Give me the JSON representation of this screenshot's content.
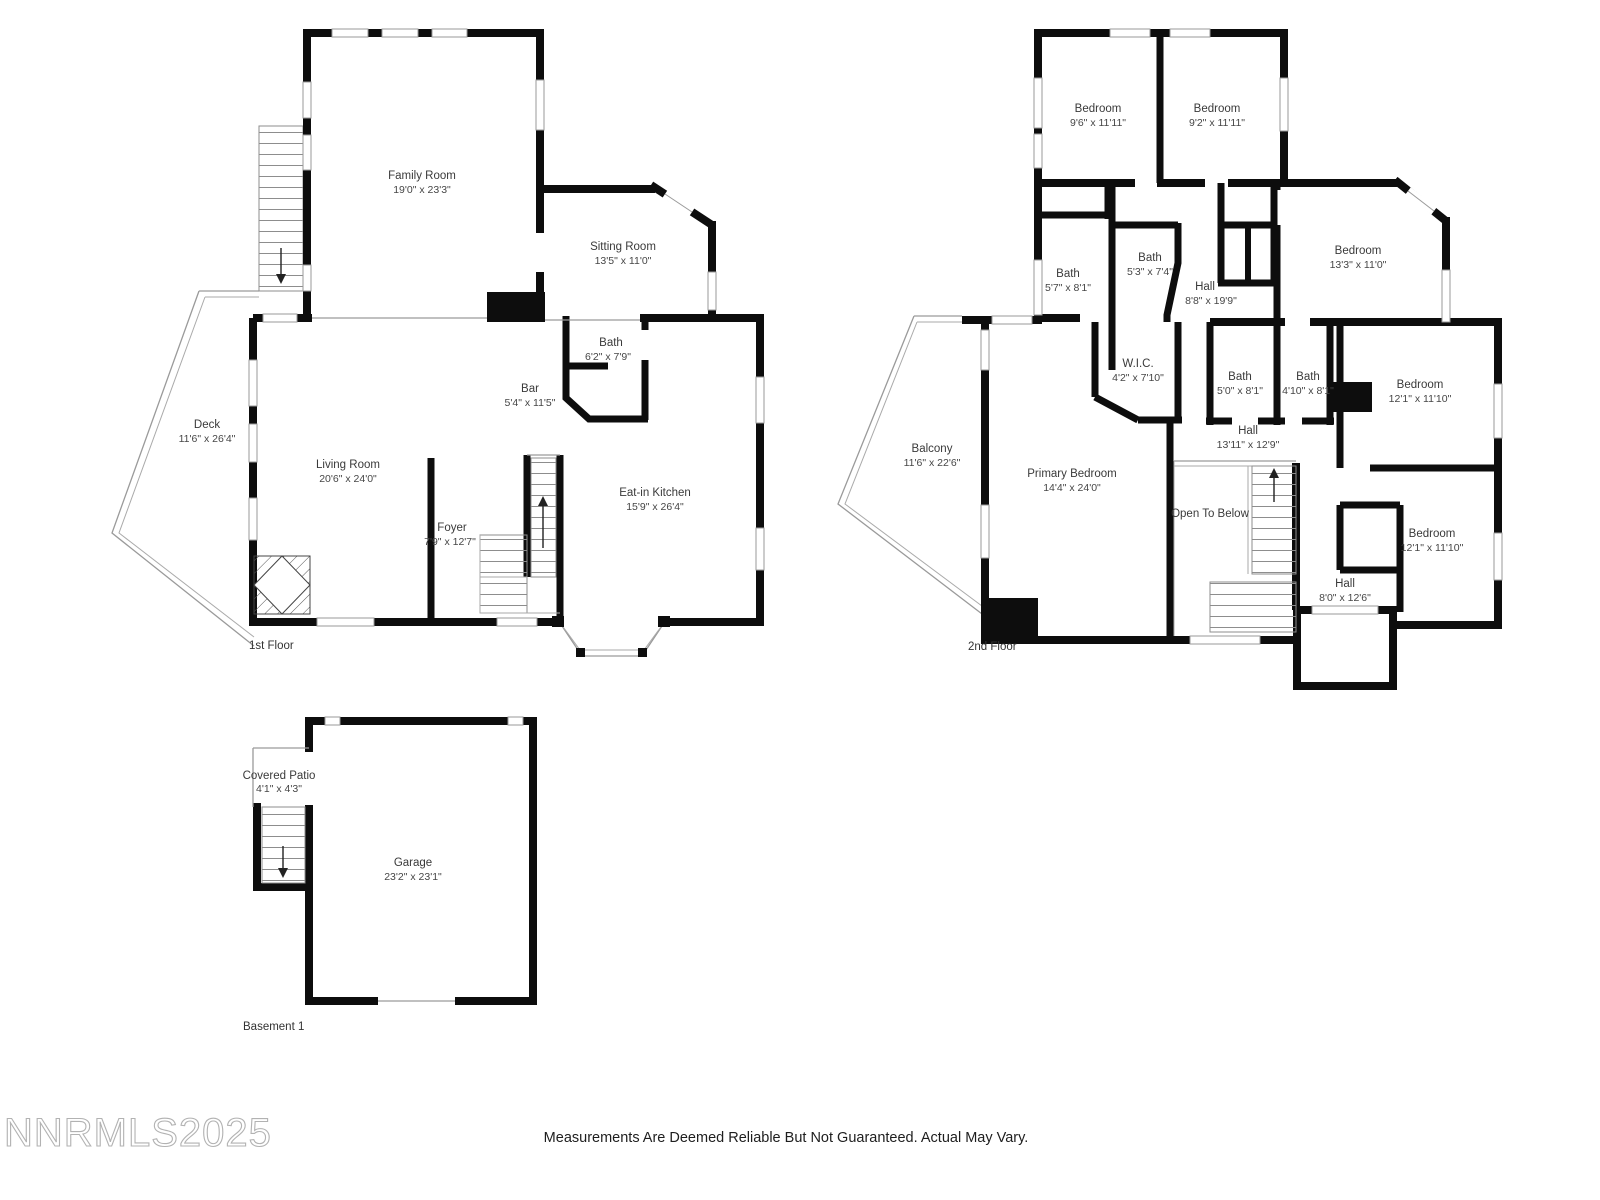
{
  "floors": [
    {
      "label": "1st Floor",
      "rooms": [
        {
          "name": "Family Room",
          "dims": "19'0\" x 23'3\""
        },
        {
          "name": "Sitting Room",
          "dims": "13'5\" x 11'0\""
        },
        {
          "name": "Bath",
          "dims": "6'2\" x 7'9\""
        },
        {
          "name": "Bar",
          "dims": "5'4\" x 11'5\""
        },
        {
          "name": "Deck",
          "dims": "11'6\" x 26'4\""
        },
        {
          "name": "Living Room",
          "dims": "20'6\" x 24'0\""
        },
        {
          "name": "Foyer",
          "dims": "7'9\" x 12'7\""
        },
        {
          "name": "Eat-in Kitchen",
          "dims": "15'9\" x 26'4\""
        }
      ]
    },
    {
      "label": "2nd Floor",
      "rooms": [
        {
          "name": "Bedroom",
          "dims": "9'6\" x 11'11\""
        },
        {
          "name": "Bedroom",
          "dims": "9'2\" x 11'11\""
        },
        {
          "name": "Bedroom",
          "dims": "13'3\" x 11'0\""
        },
        {
          "name": "Bath",
          "dims": "5'7\" x 8'1\""
        },
        {
          "name": "Bath",
          "dims": "5'3\" x 7'4\""
        },
        {
          "name": "Hall",
          "dims": "8'8\" x 19'9\""
        },
        {
          "name": "W.I.C.",
          "dims": "4'2\" x 7'10\""
        },
        {
          "name": "Bath",
          "dims": "5'0\" x 8'1\""
        },
        {
          "name": "Bath",
          "dims": "4'10\" x 8'1\""
        },
        {
          "name": "Bedroom",
          "dims": "12'1\" x 11'10\""
        },
        {
          "name": "Hall",
          "dims": "13'11\" x 12'9\""
        },
        {
          "name": "Balcony",
          "dims": "11'6\" x 22'6\""
        },
        {
          "name": "Primary Bedroom",
          "dims": "14'4\" x 24'0\""
        },
        {
          "name": "Open To Below",
          "dims": ""
        },
        {
          "name": "Bedroom",
          "dims": "12'1\" x 11'10\""
        },
        {
          "name": "Hall",
          "dims": "8'0\" x 12'6\""
        }
      ]
    },
    {
      "label": "Basement 1",
      "rooms": [
        {
          "name": "Covered Patio",
          "dims": "4'1\" x 4'3\""
        },
        {
          "name": "Garage",
          "dims": "23'2\" x 23'1\""
        }
      ]
    }
  ],
  "watermark": "NNRMLS2025",
  "disclaimer": "Measurements Are Deemed Reliable But Not Guaranteed. Actual May Vary."
}
